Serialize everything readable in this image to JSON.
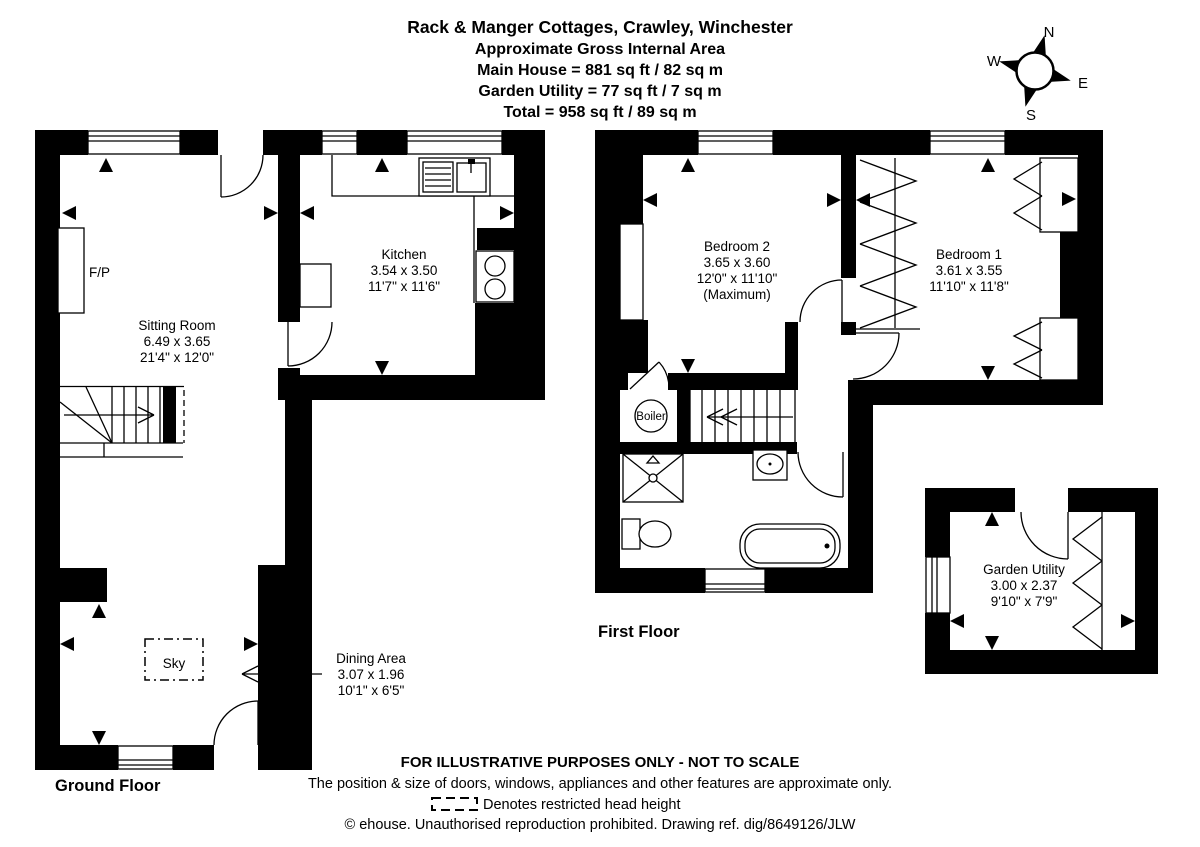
{
  "header": {
    "title": "Rack & Manger Cottages, Crawley, Winchester",
    "subtitle": "Approximate Gross Internal Area",
    "area_main": "Main House = 881 sq ft / 82 sq m",
    "area_garden": "Garden Utility = 77 sq ft / 7 sq m",
    "area_total": "Total = 958 sq ft / 89 sq m"
  },
  "compass": {
    "north": "N",
    "east": "E",
    "south": "S",
    "west": "W"
  },
  "ground_floor": {
    "label": "Ground Floor",
    "sitting_room": {
      "name": "Sitting Room",
      "metric": "6.49 x 3.65",
      "imperial": "21'4\" x 12'0\""
    },
    "kitchen": {
      "name": "Kitchen",
      "metric": "3.54 x 3.50",
      "imperial": "11'7\" x 11'6\""
    },
    "dining_area": {
      "name": "Dining Area",
      "metric": "3.07 x 1.96",
      "imperial": "10'1\" x 6'5\""
    },
    "fireplace": "F/P",
    "skylight": "Sky"
  },
  "first_floor": {
    "label": "First Floor",
    "bedroom_2": {
      "name": "Bedroom 2",
      "metric": "3.65 x 3.60",
      "imperial": "12'0\" x 11'10\"",
      "note": "(Maximum)"
    },
    "bedroom_1": {
      "name": "Bedroom 1",
      "metric": "3.61 x 3.55",
      "imperial": "11'10\" x 11'8\""
    },
    "boiler": "Boiler"
  },
  "garden_utility": {
    "name": "Garden Utility",
    "metric": "3.00 x 2.37",
    "imperial": "9'10\" x 7'9\""
  },
  "footer": {
    "line1": "FOR ILLUSTRATIVE PURPOSES ONLY - NOT TO SCALE",
    "line2": "The position & size of doors, windows, appliances and other features are approximate only.",
    "legend": "Denotes restricted head height",
    "line4": "© ehouse. Unauthorised reproduction prohibited. Drawing ref. dig/8649126/JLW"
  }
}
